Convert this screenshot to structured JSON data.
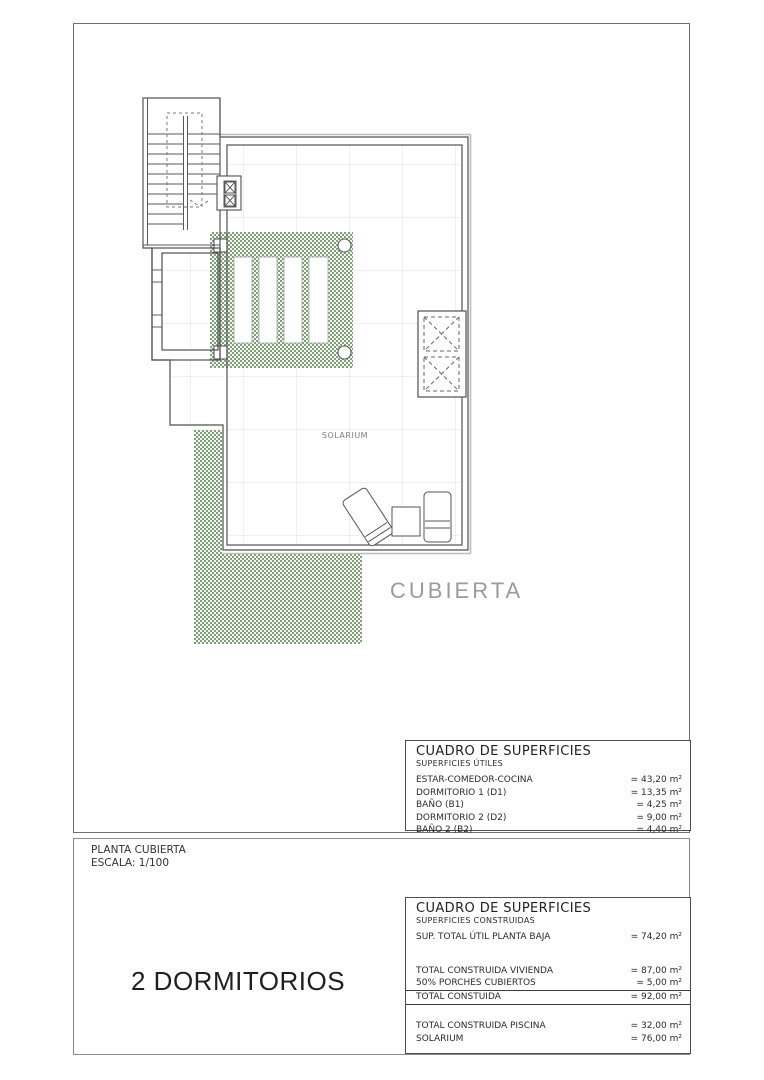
{
  "plan": {
    "labels": {
      "solarium": "SOLARIUM",
      "roof": "CUBIERTA"
    }
  },
  "title_block": {
    "plan_name": "PLANTA CUBIERTA",
    "scale": "ESCALA: 1/100",
    "type_label": "2 DORMITORIOS"
  },
  "surface_table_util": {
    "title": "CUADRO DE SUPERFICIES",
    "subtitle": "SUPERFICIES ÚTILES",
    "rows": [
      {
        "label": "ESTAR-COMEDOR-COCINA",
        "value": "= 43,20 m²"
      },
      {
        "label": "DORMITORIO 1 (D1)",
        "value": "= 13,35 m²"
      },
      {
        "label": "BAÑO  (B1)",
        "value": "= 4,25 m²"
      },
      {
        "label": "DORMITORIO 2 (D2)",
        "value": "= 9,00 m²"
      },
      {
        "label": "BAÑO 2 (B2)",
        "value": "= 4,40 m²"
      }
    ]
  },
  "surface_table_construida": {
    "title": "CUADRO DE SUPERFICIES",
    "subtitle": "SUPERFICIES CONSTRUIDAS",
    "row_util_total": {
      "label": "SUP. TOTAL ÚTIL PLANTA BAJA",
      "value": "= 74,20 m²"
    },
    "rows_construida": [
      {
        "label": "TOTAL CONSTRUIDA VIVIENDA",
        "value": "= 87,00 m²"
      },
      {
        "label": "50% PORCHES CUBIERTOS",
        "value": "= 5,00 m²"
      }
    ],
    "row_total": {
      "label": "TOTAL CONSTUIDA",
      "value": "= 92,00 m²"
    },
    "rows_exterior": [
      {
        "label": "TOTAL CONSTRUIDA PISCINA",
        "value": "= 32,00 m²"
      },
      {
        "label": "SOLARIUM",
        "value": "= 76,00 m²"
      }
    ]
  },
  "colors": {
    "hatch_green": "#7fa078",
    "grid_line": "#dce0e5",
    "wall_dark": "#4f4f4f",
    "label_gray": "#9b9b9b"
  }
}
